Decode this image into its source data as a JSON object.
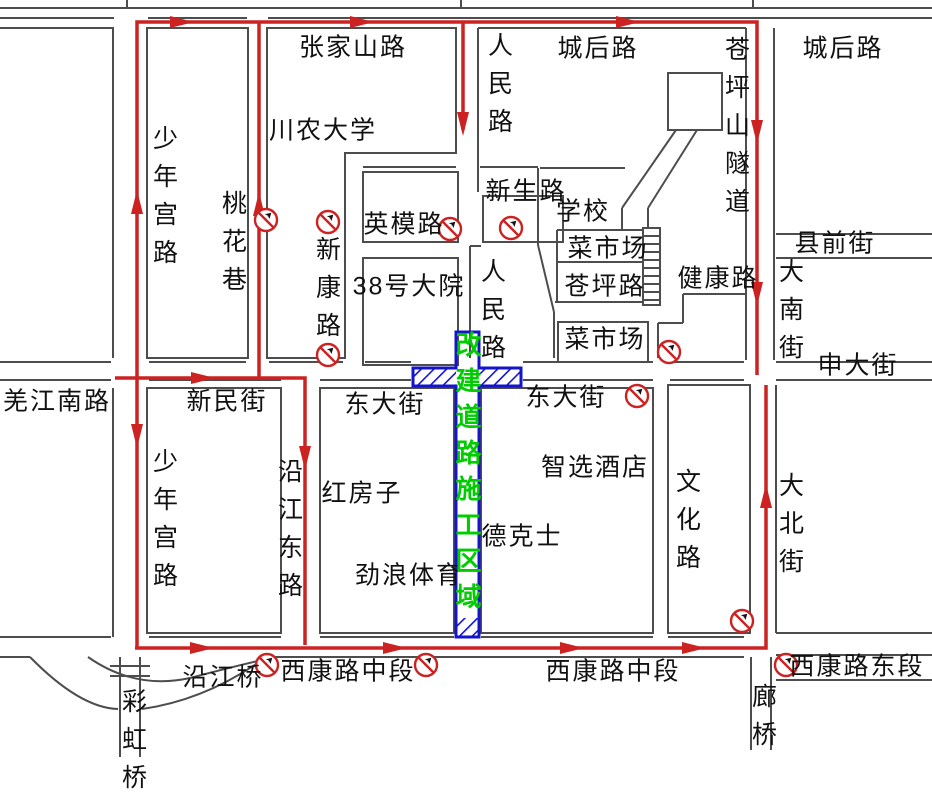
{
  "colors": {
    "road_line": "#4d4d4d",
    "detour_route": "#cc2222",
    "construction_outline": "#1414cc",
    "construction_text": "#00cc00",
    "sign_red": "#cc2222",
    "label_text": "#111111",
    "background": "#ffffff"
  },
  "icons": {
    "no_entry_sign": "red circle with diagonal slash over black arrow",
    "detour_arrow": "red triangle arrowhead showing detour direction"
  },
  "labels": {
    "zhangjiashan_road": "张家山路",
    "chenghou_road": "城后路",
    "shaoniangong_road": "少年宫路",
    "taohua_lane": "桃花巷",
    "chuannong_university": "川农大学",
    "renmin_road": "人民路",
    "xinsheng_road": "新生路",
    "yingmo_road": "英模路",
    "school": "学校",
    "vegetable_market": "菜市场",
    "cangping_road": "苍坪路",
    "xinkang_road": "新康路",
    "no38_compound": "38号大院",
    "cangpingshan_tunnel": "苍坪山隧道",
    "xianqian_street": "县前街",
    "jiankang_road": "健康路",
    "danan_street": "大南街",
    "shenda_street": "申大街",
    "qiangjiang_south_road": "羌江南路",
    "xinmin_street": "新民街",
    "dongda_street": "东大街",
    "hongfangzi": "红房子",
    "zhixuan_hotel": "智选酒店",
    "dicos": "德克士",
    "jinlang_sports": "劲浪体育",
    "wenhua_road": "文化路",
    "dabei_street": "大北街",
    "yanjiang_bridge": "沿江桥",
    "caihong_bridge": "彩虹桥",
    "xikang_road_middle": "西康路中段",
    "xikang_road_east": "西康路东段",
    "langqiao": "廊桥",
    "construction_zone": "改建道路施工区域"
  }
}
